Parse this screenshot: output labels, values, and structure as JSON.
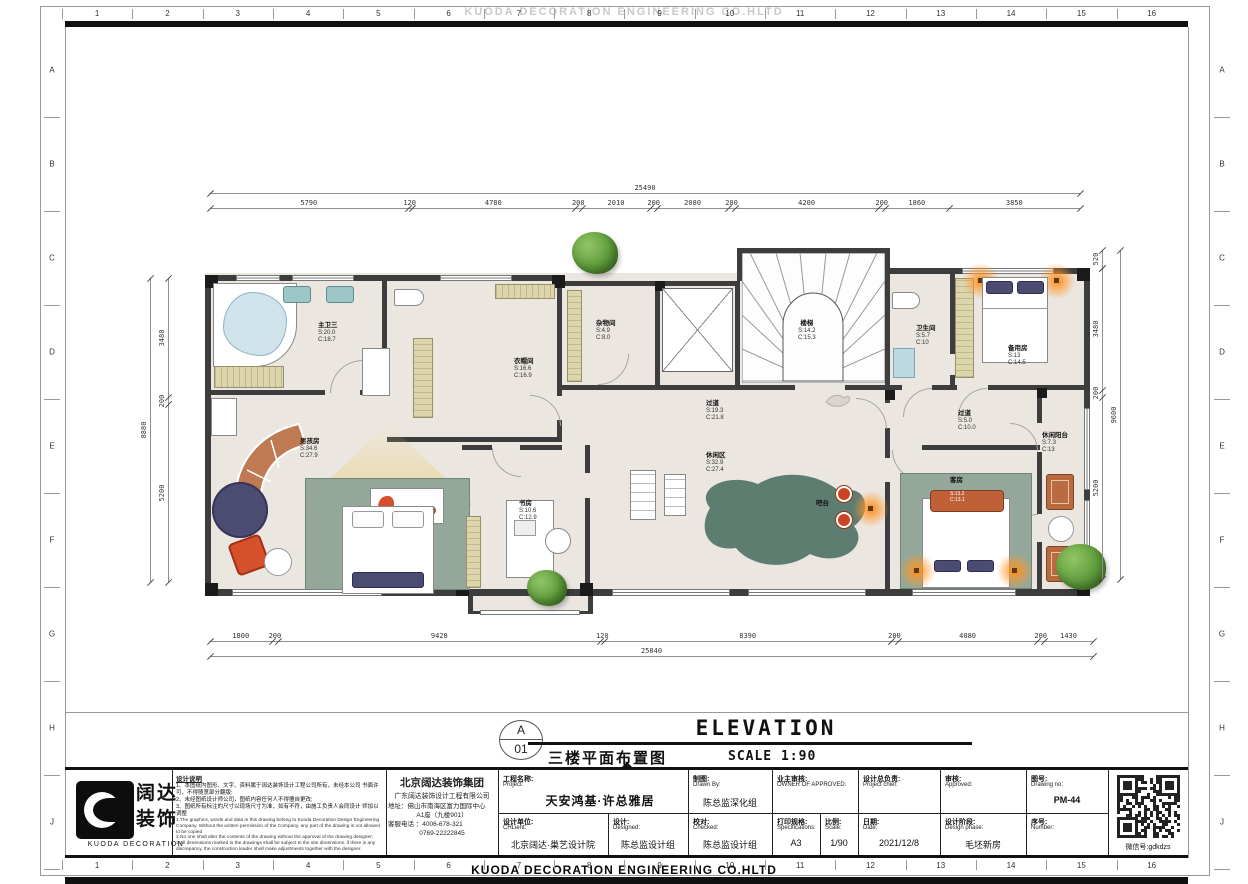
{
  "banner": {
    "top_text": "KUODA DECORATION ENGINEERING CO.HLTD",
    "bottom_text": "KUODA DECORATION ENGINEERING CO.HLTD"
  },
  "ruler": {
    "columns": [
      "1",
      "2",
      "3",
      "4",
      "5",
      "6",
      "7",
      "8",
      "9",
      "10",
      "11",
      "12",
      "13",
      "14",
      "15",
      "16"
    ],
    "rows": [
      "A",
      "B",
      "C",
      "D",
      "E",
      "F",
      "G",
      "H",
      "J"
    ]
  },
  "elevation_title": {
    "bubble_top": "A",
    "bubble_bottom": "01",
    "main": "ELEVATION",
    "sub_cn": "三楼平面布置图",
    "scale": "SCALE 1:90"
  },
  "dims": {
    "top": {
      "total": "25490",
      "segments": [
        "5790",
        "120",
        "4780",
        "200",
        "2010",
        "200",
        "2080",
        "200",
        "4200",
        "200",
        "1860",
        "3850"
      ]
    },
    "bottom": {
      "total": "25840",
      "segments": [
        "1800",
        "200",
        "9420",
        "120",
        "8390",
        "200",
        "4080",
        "200",
        "1430"
      ]
    },
    "left": {
      "total": "8880",
      "segments": [
        "3480",
        "200",
        "5200"
      ]
    },
    "right": {
      "total": "9600",
      "segments": [
        "3480",
        "200",
        "5200"
      ],
      "top_extra": "520"
    }
  },
  "rooms": {
    "master_bath": {
      "name": "主卫三",
      "s": "S:20.0",
      "c": "C:18.7"
    },
    "cloakroom": {
      "name": "衣帽间",
      "s": "S:16.6",
      "c": "C:16.9"
    },
    "storage": {
      "name": "杂物间",
      "s": "S:4.9",
      "c": "C:8.0"
    },
    "stairs": {
      "name": "楼梯",
      "s": "S:14.2",
      "c": "C:15.3"
    },
    "bathroom": {
      "name": "卫生间",
      "s": "S:5.7",
      "c": "C:10"
    },
    "spare": {
      "name": "备用房",
      "s": "S:13",
      "c": "C:14.5"
    },
    "corridor_main": {
      "name": "过道",
      "s": "S:19.3",
      "c": "C:21.8"
    },
    "corridor_right": {
      "name": "过道",
      "s": "S:5.0",
      "c": "C:10.0"
    },
    "balcony": {
      "name": "休闲阳台",
      "s": "S:7.3",
      "c": "C:13"
    },
    "boys_room": {
      "name": "男孩房",
      "s": "S:34.6",
      "c": "C:27.9"
    },
    "study": {
      "name": "书房",
      "s": "S:10.6",
      "c": "C:12.9"
    },
    "leisure": {
      "name": "休闲区",
      "s": "S:32.9",
      "c": "C:27.4"
    },
    "bar": {
      "name": "吧台"
    },
    "guest": {
      "name": "客房",
      "s": "S:13.2",
      "c": "C:13.1"
    }
  },
  "logo": {
    "cn1": "阔达",
    "cn2": "装饰",
    "en": "KUODA DECORATION"
  },
  "notes": {
    "header": "设计说明",
    "cn": [
      "1、本图纸内图形、文字、资料属于阔达装饰设计工程公司所有，未经本公司 书面许可，不得随意部分翻版;",
      "2、未经图纸设计师公司，图纸内容任何人不得擅自更改;",
      "3、图纸所有标注的尺寸以现场尺寸为准，如有不符，由施工负责人会同设计 师加以调整"
    ],
    "en": [
      "1.The graphics, words and data in this drawing belong to Kuoda Decoration Design Engineering Company. Without the written permission of the Company, any part of the drawing is not allowed to be copied",
      "2.No one shall alter the contents of the drawing without the approval of the drawing designer;",
      "3.All dimensions marked in the drawings shall be subject to the site dimensions. if there is any discrepancy, the construction leader shall make adjustments together with the designer."
    ]
  },
  "company": {
    "group": "北京阔达装饰集团",
    "name": "广东阔达装饰设计工程有限公司",
    "address1": "地址：佛山市南海区富力国际中心",
    "address2": "A1座（九楼901）",
    "phone1": "客服电话 ：4006-678-321",
    "phone2": "0769-22222845"
  },
  "title_block": {
    "project": {
      "cn": "工程名称:",
      "en": "Project:",
      "value": "天安鸿基·许总雅居"
    },
    "client": {
      "cn": "设计单位:",
      "en": "CHLient:",
      "value": "北京阔达·巢艺设计院"
    },
    "designed": {
      "cn": "设计:",
      "en": "Designed:",
      "value": "陈总监设计组"
    },
    "drawn_by": {
      "cn": "制图:",
      "en": "Drawn By:",
      "value": "陈总监深化组"
    },
    "checked": {
      "cn": "校对:",
      "en": "Checked:",
      "value": "陈总监设计组"
    },
    "owner": {
      "cn": "业主审核:",
      "en": "OWNER OF APPROVED:",
      "value": ""
    },
    "spec": {
      "cn": "打印规格:",
      "en": "Specifications:",
      "value": "A3"
    },
    "scale": {
      "cn": "比例:",
      "en": "Scale:",
      "value": "1/90"
    },
    "chief": {
      "cn": "设计总负责:",
      "en": "Project chief:",
      "value": ""
    },
    "date": {
      "cn": "日期:",
      "en": "Date:",
      "value": "2021/12/8"
    },
    "approved": {
      "cn": "审核:",
      "en": "Approved:",
      "value": ""
    },
    "phase": {
      "cn": "设计阶段:",
      "en": "Design phase:",
      "value": "毛坯新房"
    },
    "drawing_no": {
      "cn": "图号:",
      "en": "Drawing no:",
      "value": "PM-44"
    },
    "number": {
      "cn": "序号:",
      "en": "Number:",
      "value": ""
    }
  },
  "qr_caption": "微信号:gdkdzs",
  "colors": {
    "floor": "#ece6e0",
    "wall": "#3d3d3d",
    "cabinet": "#ddd6ab",
    "sage": "#93a89a",
    "teal_blob": "#5e7d71",
    "terracotta": "#bf7a54",
    "navy": "#4c4b71",
    "red_orange": "#d6502c",
    "glow": "#ff8c1a",
    "plant": "#5d9b3a",
    "tub": "#cfe3ea"
  }
}
